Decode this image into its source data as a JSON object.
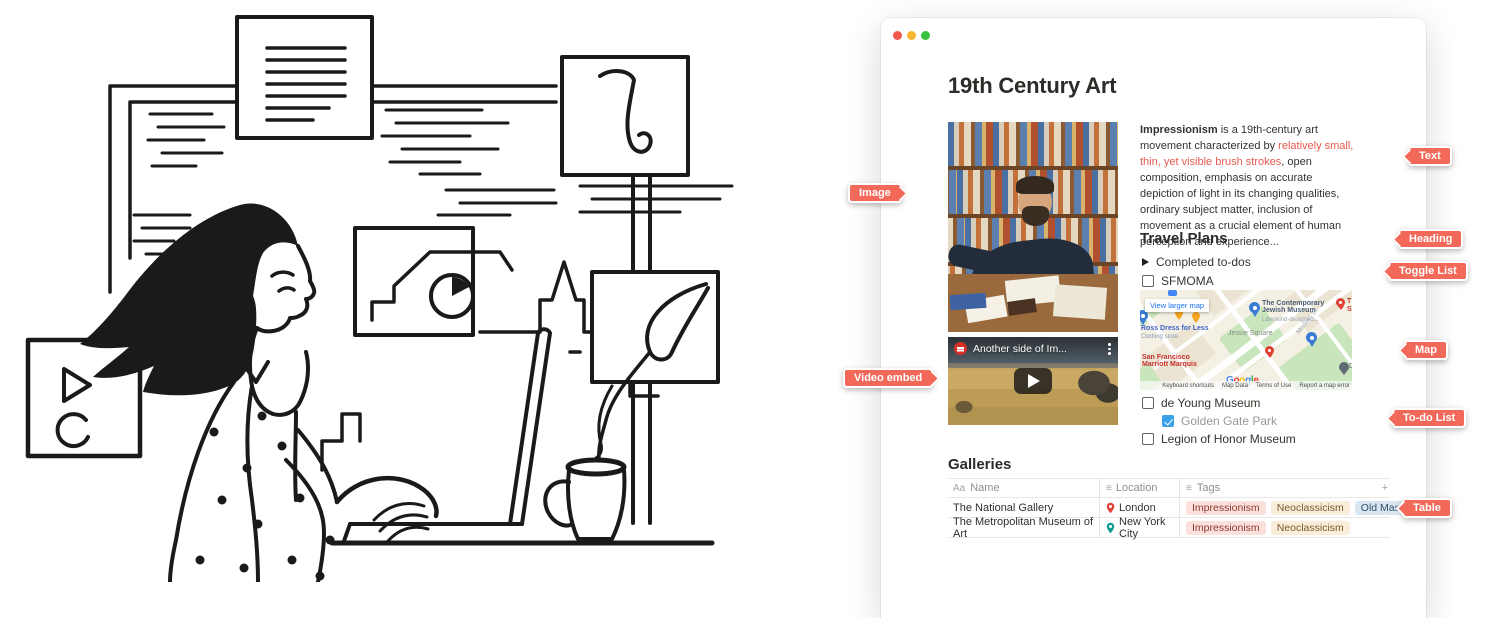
{
  "colors": {
    "accent": "#f2695a",
    "red_text": "#e65a4f",
    "checkbox_blue": "#3aa0e8",
    "traffic_red": "#f4584c",
    "traffic_yellow": "#f7b731",
    "traffic_green": "#38c23d"
  },
  "callouts": {
    "image": "Image",
    "video": "Video embed",
    "text": "Text",
    "heading": "Heading",
    "toggle": "Toggle List",
    "map": "Map",
    "todo": "To-do List",
    "table": "Table"
  },
  "window": {
    "title": "19th Century Art",
    "paragraph": {
      "bold": "Impressionism",
      "pre": " is a 19th-century art movement characterized by ",
      "red": "relatively small, thin, yet visible brush strokes",
      "post": ", open composition, emphasis on accurate depiction of light in its changing qualities, ordinary subject matter, inclusion of movement as a crucial element of human perception and experience..."
    },
    "travel_heading": "Travel Plans",
    "toggle_label": "Completed to-dos",
    "todos": [
      {
        "label": "SFMOMA",
        "checked": false
      },
      {
        "label": "de Young Museum",
        "checked": false
      },
      {
        "label": "Golden Gate Park",
        "checked": true
      },
      {
        "label": "Legion of Honor Museum",
        "checked": false
      }
    ],
    "video": {
      "title": "Another side of Im..."
    },
    "map": {
      "view_larger": "View larger map",
      "poi1_line1": "The Contemporary",
      "poi1_line2": "Jewish Museum",
      "poi1_sub": "Libeskind-designed...",
      "ross": "Ross Dress for Less",
      "ross_sub": "Clothing store",
      "jessie": "Jessie Square",
      "mission": "Mission St",
      "marriott_line1": "San Francisco",
      "marriott_line2": "Marriott Marquis",
      "frag_t": "T",
      "frag_s": "S",
      "frag_d": "D",
      "google_letters": [
        "G",
        "o",
        "o",
        "g",
        "l",
        "e"
      ],
      "attribution": [
        "Keyboard shortcuts",
        "Map Data",
        "Terms of Use",
        "Report a map error"
      ]
    },
    "galleries_heading": "Galleries",
    "table": {
      "headers": {
        "name_icon": "Aa",
        "name": "Name",
        "loc_icon": "≡",
        "location": "Location",
        "tags_icon": "≡",
        "tags": "Tags",
        "add": "+"
      },
      "rows": [
        {
          "name": "The National Gallery",
          "location": "London",
          "tags": [
            {
              "label": "Impressionism",
              "color": "red"
            },
            {
              "label": "Neoclassicism",
              "color": "yellow"
            },
            {
              "label": "Old Masters",
              "color": "blue"
            }
          ]
        },
        {
          "name": "The Metropolitan Museum of Art",
          "location": "New York City",
          "tags": [
            {
              "label": "Impressionism",
              "color": "red"
            },
            {
              "label": "Neoclassicism",
              "color": "yellow"
            }
          ]
        }
      ]
    }
  }
}
